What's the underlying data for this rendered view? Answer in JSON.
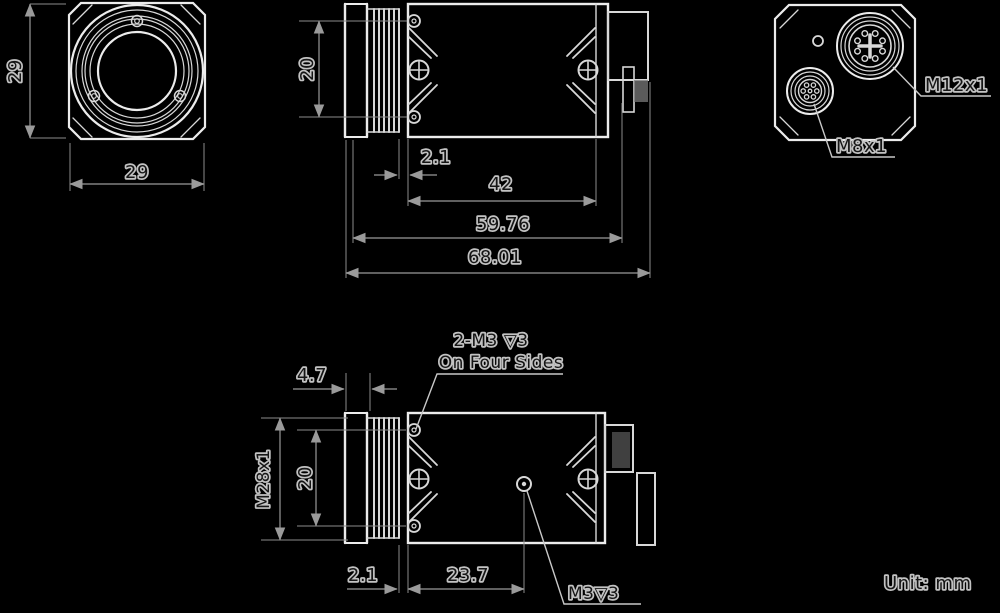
{
  "drawing": {
    "unit_note": "Unit: mm",
    "front_view": {
      "height_dim": "29",
      "width_dim": "29"
    },
    "side_view_top": {
      "hole_spacing_dim": "20",
      "gap_dim": "2.1",
      "body_length_dim": "42",
      "mount_length_dim": "59.76",
      "total_length_dim": "68.01"
    },
    "rear_view": {
      "m12_label": "M12x1",
      "m8_label": "M8x1"
    },
    "side_view_bottom": {
      "ring_width_dim": "4.7",
      "lens_thread_label": "M28x1",
      "hole_spacing_dim": "20",
      "gap_dim": "2.1",
      "hole_offset_dim": "23.7",
      "m3_hole_label": "M3▽3",
      "callout_line1": "2-M3 ▽3",
      "callout_line2": "On Four Sides"
    },
    "colors": {
      "background": "#000000",
      "outline": "#ececec",
      "dim_lines": "#9a9a9a",
      "label_fill": "#151515",
      "label_halo": "#c2c2c2"
    }
  }
}
